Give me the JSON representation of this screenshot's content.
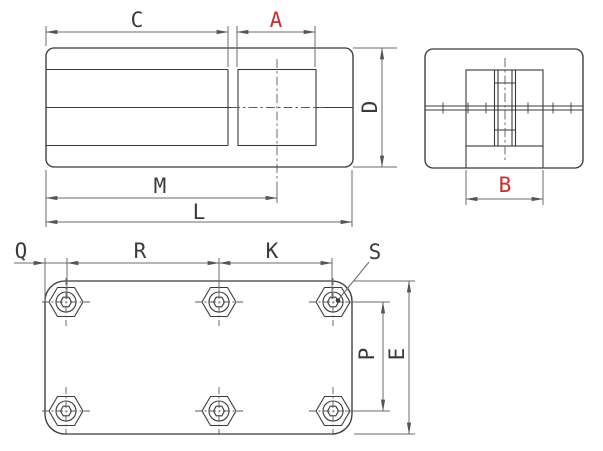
{
  "drawing": {
    "dimension_labels": {
      "c": "C",
      "a": "A",
      "d": "D",
      "m": "M",
      "l": "L",
      "b": "B",
      "q": "Q",
      "r": "R",
      "k": "K",
      "s": "S",
      "p": "P",
      "e": "E"
    },
    "highlighted_dimensions": [
      "A",
      "B"
    ],
    "colors": {
      "highlight_dimension": "#c62f2f",
      "line": "#3a3a3a",
      "dimension_line": "#6b6b6b",
      "background": "#ffffff"
    }
  }
}
